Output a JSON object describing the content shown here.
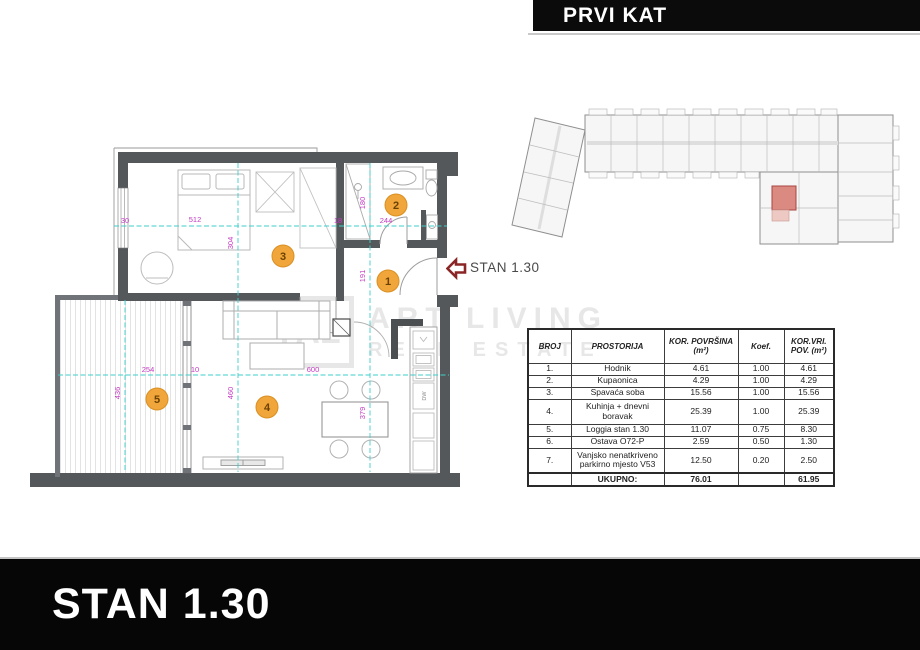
{
  "header": {
    "title": "PRVI KAT"
  },
  "footer": {
    "title": "STAN 1.30"
  },
  "pointer": {
    "label": "STAN 1.30"
  },
  "watermark": {
    "logo": "AL",
    "line1": "ART LIVING",
    "line2": "REAL ESTATE"
  },
  "plan": {
    "rooms": [
      {
        "number": "1",
        "name": "Hodnik"
      },
      {
        "number": "2",
        "name": "Kupaonica"
      },
      {
        "number": "3",
        "name": "Spavaća soba"
      },
      {
        "number": "4",
        "name": "Kuhinja + dnevni boravak"
      },
      {
        "number": "5",
        "name": "Loggia"
      }
    ],
    "dims": {
      "left_wall": "30",
      "bedroom_w": "512",
      "bedroom_h": "304",
      "bath_wall": "18",
      "bath_w": "244",
      "bath_h": "180",
      "hall_h": "191",
      "loggia_w": "254",
      "divider": "10",
      "living_w": "600",
      "loggia_h": "436",
      "living_h": "460",
      "kitchen_h": "379"
    },
    "labels": {
      "dishwasher": "DW"
    },
    "colors": {
      "wall": "#55585b",
      "dimension_line": "#3ecfca",
      "dimension_text": "#c23ac2",
      "room_badge": "#f0a63a",
      "arrow": "#8b2525",
      "highlight_unit": "#db8a82"
    }
  },
  "table": {
    "headers": {
      "broj": "BROJ",
      "prostorija": "PROSTORIJA",
      "povrsina": "KOR. POVRŠINA (m²)",
      "koef": "Koef.",
      "vrijednost": "KOR.VRI. POV. (m²)"
    },
    "rows": [
      {
        "broj": "1.",
        "prostorija": "Hodnik",
        "povrsina": "4.61",
        "koef": "1.00",
        "vrijednost": "4.61"
      },
      {
        "broj": "2.",
        "prostorija": "Kupaonica",
        "povrsina": "4.29",
        "koef": "1.00",
        "vrijednost": "4.29"
      },
      {
        "broj": "3.",
        "prostorija": "Spavaća soba",
        "povrsina": "15.56",
        "koef": "1.00",
        "vrijednost": "15.56"
      },
      {
        "broj": "4.",
        "prostorija": "Kuhinja + dnevni boravak",
        "povrsina": "25.39",
        "koef": "1.00",
        "vrijednost": "25.39"
      },
      {
        "broj": "5.",
        "prostorija": "Loggia stan 1.30",
        "povrsina": "11.07",
        "koef": "0.75",
        "vrijednost": "8.30"
      },
      {
        "broj": "6.",
        "prostorija": "Ostava O72-P",
        "povrsina": "2.59",
        "koef": "0.50",
        "vrijednost": "1.30"
      },
      {
        "broj": "7.",
        "prostorija": "Vanjsko nenatkriveno parkirno mjesto V53",
        "povrsina": "12.50",
        "koef": "0.20",
        "vrijednost": "2.50"
      }
    ],
    "total": {
      "label": "UKUPNO:",
      "povrsina": "76.01",
      "vrijednost": "61.95"
    }
  }
}
